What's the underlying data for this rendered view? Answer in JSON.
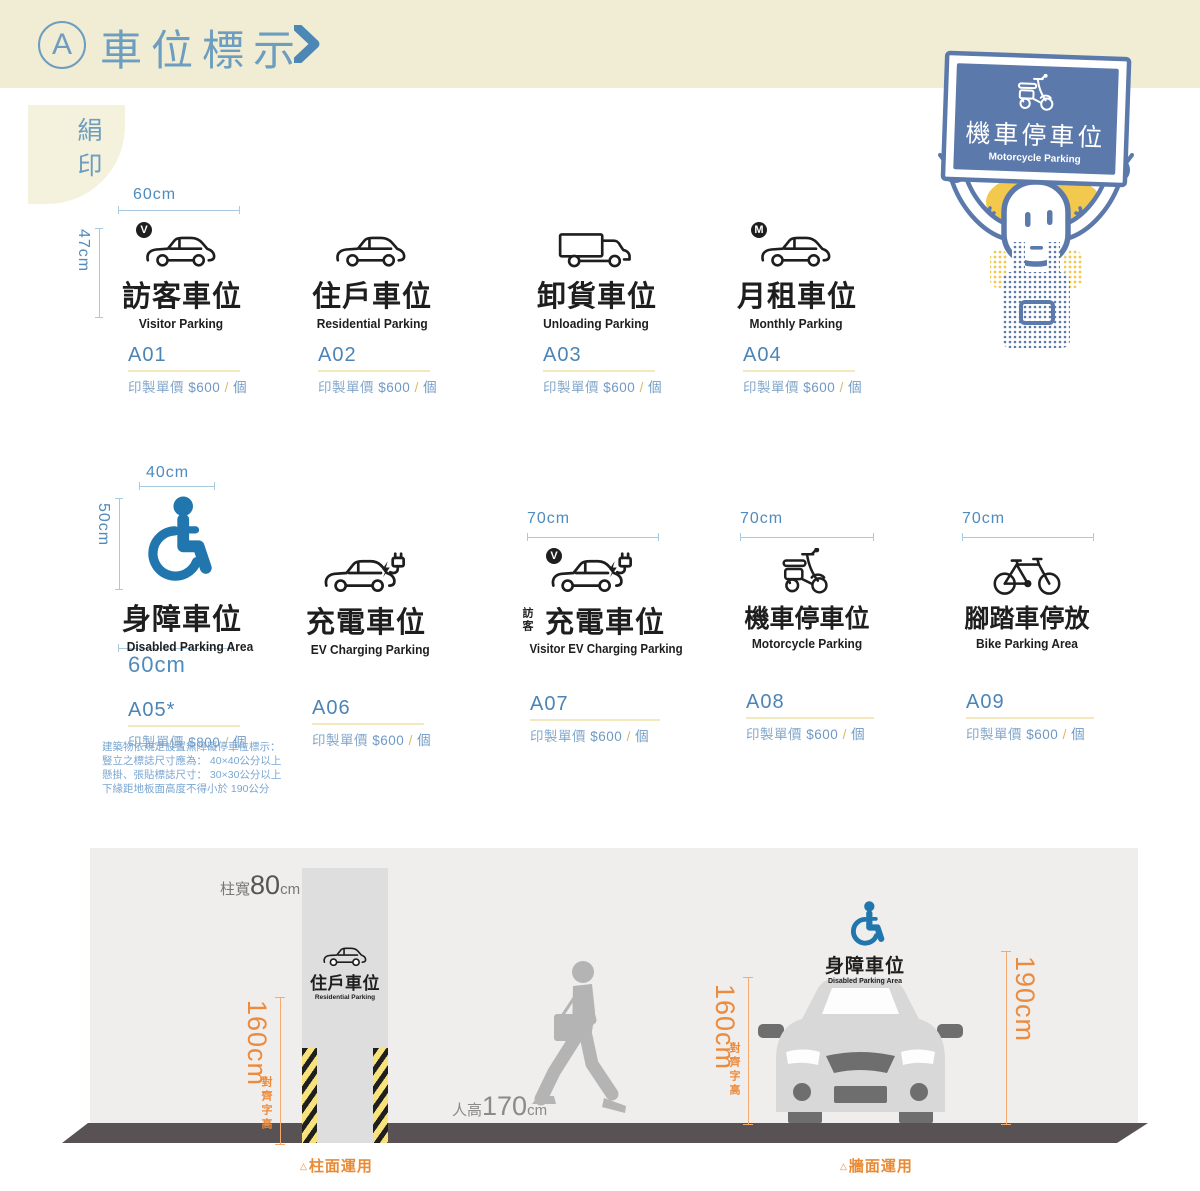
{
  "header": {
    "badge": "A",
    "title": "車位標示"
  },
  "process_tab": {
    "label": "絹印"
  },
  "illustration": {
    "icon": "scooter-icon",
    "sign_title": "機車停車位",
    "sign_subtitle": "Motorcycle Parking",
    "description": "hand-drawn character holding up a blue motorcycle-parking sign"
  },
  "shared": {
    "price_label": "印製單價",
    "slash": "/",
    "unit": "個"
  },
  "items": [
    {
      "code": "A01",
      "title": "訪客車位",
      "subtitle": "Visitor Parking",
      "amount": "$600",
      "icon": "car-side-icon",
      "badge": "V",
      "dims": {
        "top": "60cm",
        "left": "47cm"
      }
    },
    {
      "code": "A02",
      "title": "住戶車位",
      "subtitle": "Residential Parking",
      "amount": "$600",
      "icon": "car-side-icon"
    },
    {
      "code": "A03",
      "title": "卸貨車位",
      "subtitle": "Unloading Parking",
      "amount": "$600",
      "icon": "truck-icon"
    },
    {
      "code": "A04",
      "title": "月租車位",
      "subtitle": "Monthly Parking",
      "amount": "$600",
      "icon": "car-side-icon",
      "badge": "M"
    },
    {
      "code": "A05*",
      "title": "身障車位",
      "subtitle": "Disabled Parking Area",
      "amount": "$800",
      "icon": "wheelchair-icon",
      "dims": {
        "top": "40cm",
        "left": "50cm",
        "bottom": "60cm"
      }
    },
    {
      "code": "A06",
      "title": "充電車位",
      "subtitle": "EV Charging Parking",
      "amount": "$600",
      "icon": "car-charging-icon"
    },
    {
      "code": "A07",
      "title_prefix": "訪客",
      "title": "充電車位",
      "subtitle": "Visitor EV Charging Parking",
      "amount": "$600",
      "icon": "car-charging-icon",
      "badge": "V",
      "dims": {
        "top": "70cm"
      }
    },
    {
      "code": "A08",
      "title": "機車停車位",
      "subtitle": "Motorcycle Parking",
      "amount": "$600",
      "icon": "scooter-icon",
      "dims": {
        "top": "70cm"
      }
    },
    {
      "code": "A09",
      "title": "腳踏車停放",
      "subtitle": "Bike Parking Area",
      "amount": "$600",
      "icon": "bicycle-icon",
      "dims": {
        "top": "70cm"
      }
    }
  ],
  "note": {
    "line1": "建築物依規定設置無障礙停車位標示：",
    "line2": "豎立之標誌尺寸應為： 40×40公分以上",
    "line3": "懸掛、張貼標誌尺寸： 30×30公分以上",
    "line4": "下緣距地板面高度不得小於 190公分"
  },
  "diagram": {
    "column_width": {
      "prefix": "柱寬",
      "value": "80",
      "unit": "cm"
    },
    "column_sign": {
      "title": "住戶車位",
      "subtitle": "Residential Parking",
      "icon": "car-side-icon"
    },
    "column_dim": {
      "value": "160cm",
      "note": "對齊字高"
    },
    "person": {
      "prefix": "人高",
      "value": "170",
      "unit": "cm"
    },
    "wall_sign": {
      "title": "身障車位",
      "subtitle": "Disabled Parking Area",
      "icon": "wheelchair-icon"
    },
    "wall_dim_text": {
      "value": "160cm",
      "note": "對齊字高"
    },
    "wall_dim_sign": {
      "value": "190cm"
    },
    "caption_column": {
      "marker": "△",
      "label": "柱面運用"
    },
    "caption_wall": {
      "marker": "△",
      "label": "牆面運用"
    }
  },
  "colors": {
    "accent_blue": "#6d9dbf",
    "code_blue": "#4c84b6",
    "dim_blue": "#a9c9e0",
    "underline_yellow": "#f3e9bd",
    "orange": "#ed8b3d",
    "cream": "#f0edd4",
    "wheelchair_blue": "#2176ad",
    "illustration_blue": "#5b79ab",
    "hair_yellow": "#f2c94c",
    "floor_gray": "#585254",
    "panel_gray": "#efeeed",
    "person_gray": "#b4b4b4"
  }
}
